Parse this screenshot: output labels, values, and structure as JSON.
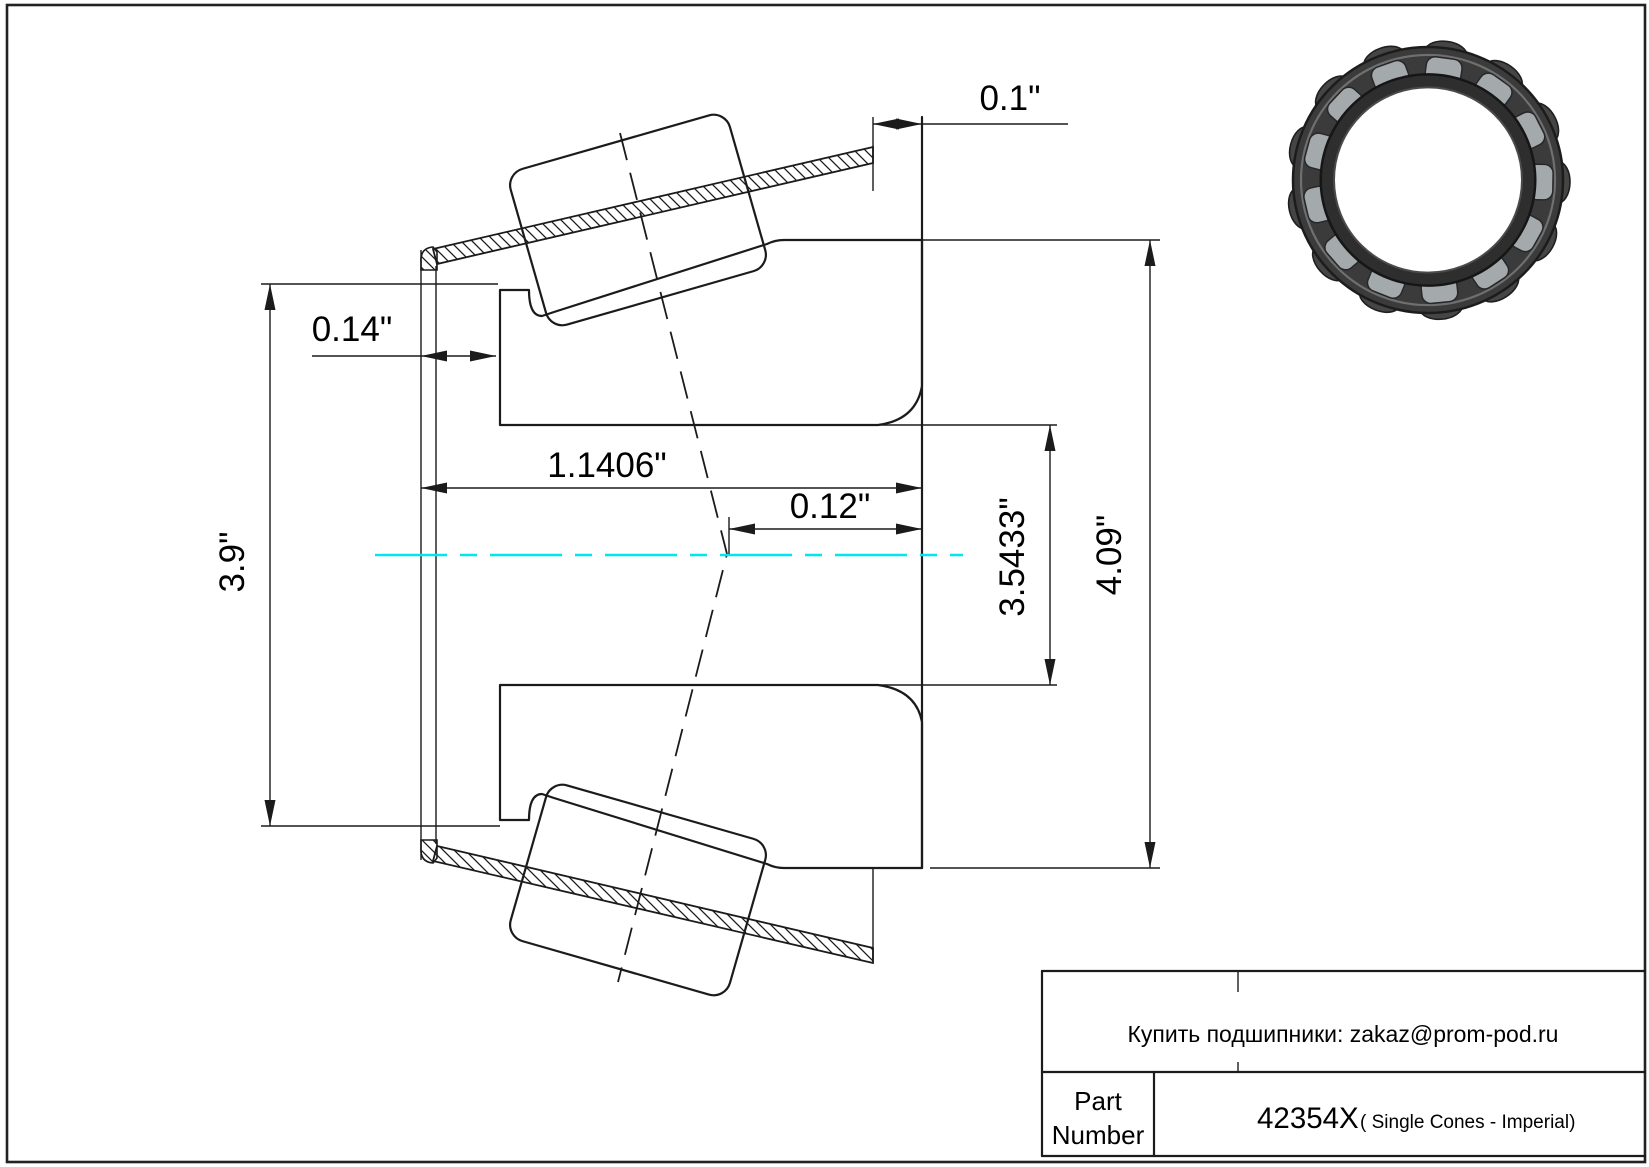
{
  "page": {
    "background": "#ffffff",
    "border_color": "#222222"
  },
  "drawing": {
    "centerline_color": "#00e6ee",
    "dims": {
      "overhang": "0.1\"",
      "front_width": "0.14\"",
      "cone_width": "1.1406\"",
      "load_center": "0.12\"",
      "bore": "3.5433\"",
      "outer": "4.09\"",
      "rib": "3.9\""
    }
  },
  "title_block": {
    "contact": "Купить подшипники: zakaz@prom-pod.ru",
    "part_label_line1": "Part",
    "part_label_line2": "Number",
    "part_number": "42354X",
    "part_suffix": "( Single Cones - Imperial)"
  }
}
